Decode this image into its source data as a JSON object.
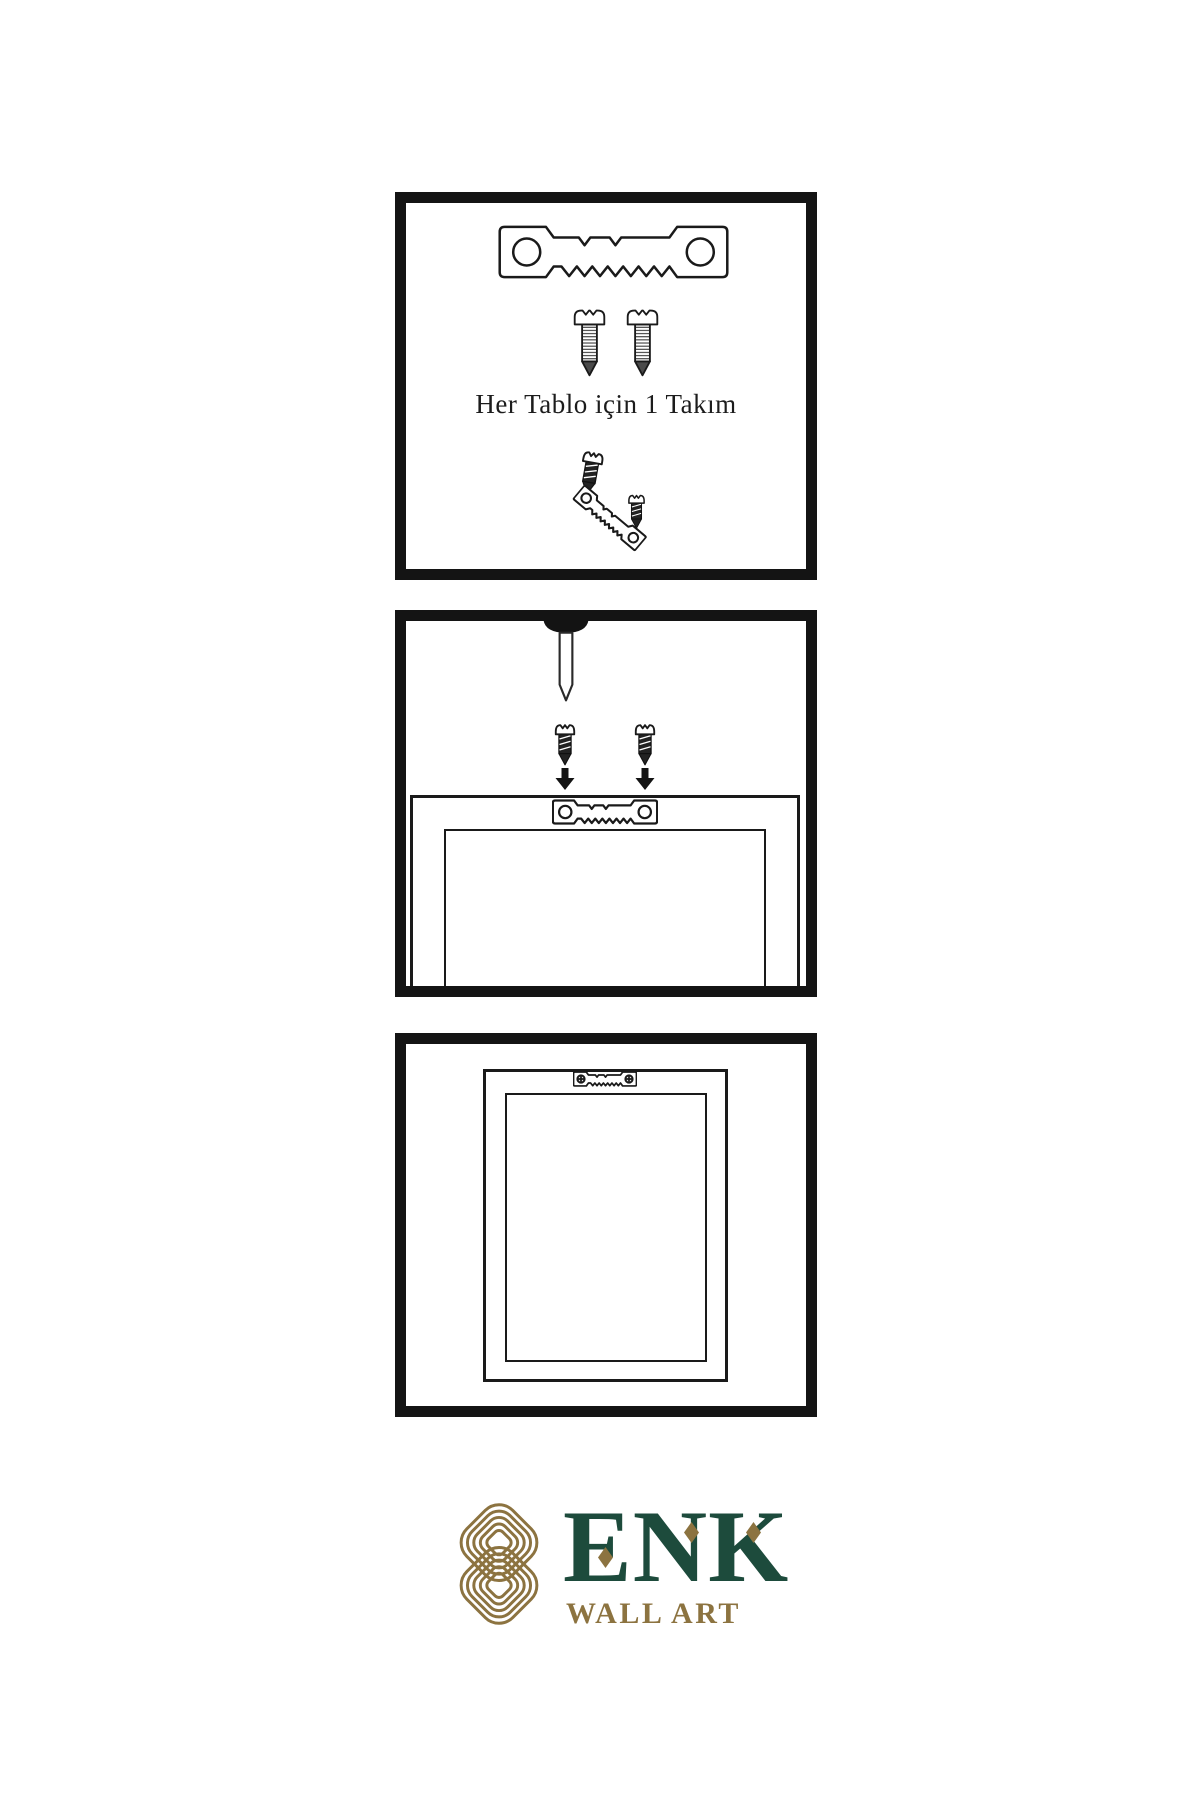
{
  "panel_kit": {
    "caption": "Her Tablo için 1 Takım"
  },
  "logo": {
    "brand": "ENK",
    "subtitle": "WALL ART"
  },
  "colors": {
    "line": "#1a1a1a",
    "panel_border": "#141414",
    "brand_green": "#1d4b3c",
    "brand_gold": "#8c7340",
    "background": "#ffffff"
  },
  "icons": {
    "sawtooth_hanger": "sawtooth picture hanger plate with two holes",
    "screw_threaded": "threaded screw, side view",
    "screw_dark": "small dark screw",
    "nail": "wall nail pointing down",
    "arrow_down": "black downward arrow",
    "hanger_with_screws": "sawtooth hanger fastened with two phillips screws",
    "knot": "interlocked double-loop brand knot"
  }
}
